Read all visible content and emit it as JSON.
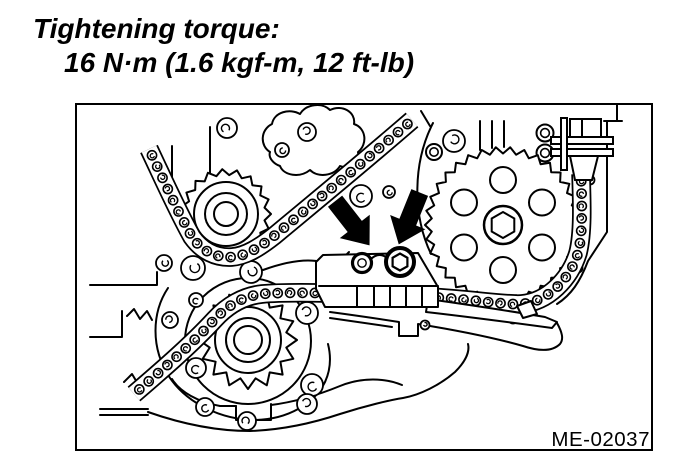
{
  "page": {
    "background_color": "#ffffff",
    "text_color": "#000000"
  },
  "torque_note": {
    "heading": "Tightening torque:",
    "value": "16 N·m (1.6 kgf-m, 12 ft-lb)"
  },
  "figure": {
    "code": "ME-02037",
    "type": "engine-timing-chain-line-drawing",
    "line_color": "#000000",
    "arrow_color": "#000000",
    "callouts": [
      "bolt-callout-arrow-left",
      "bolt-callout-arrow-right"
    ],
    "components": [
      "timing-chain",
      "idler-sprocket",
      "camshaft-sprocket",
      "oil-pump-sprocket",
      "chain-tensioner",
      "chain-guide-bracket",
      "torque-bolts",
      "engine-front-cover"
    ]
  }
}
